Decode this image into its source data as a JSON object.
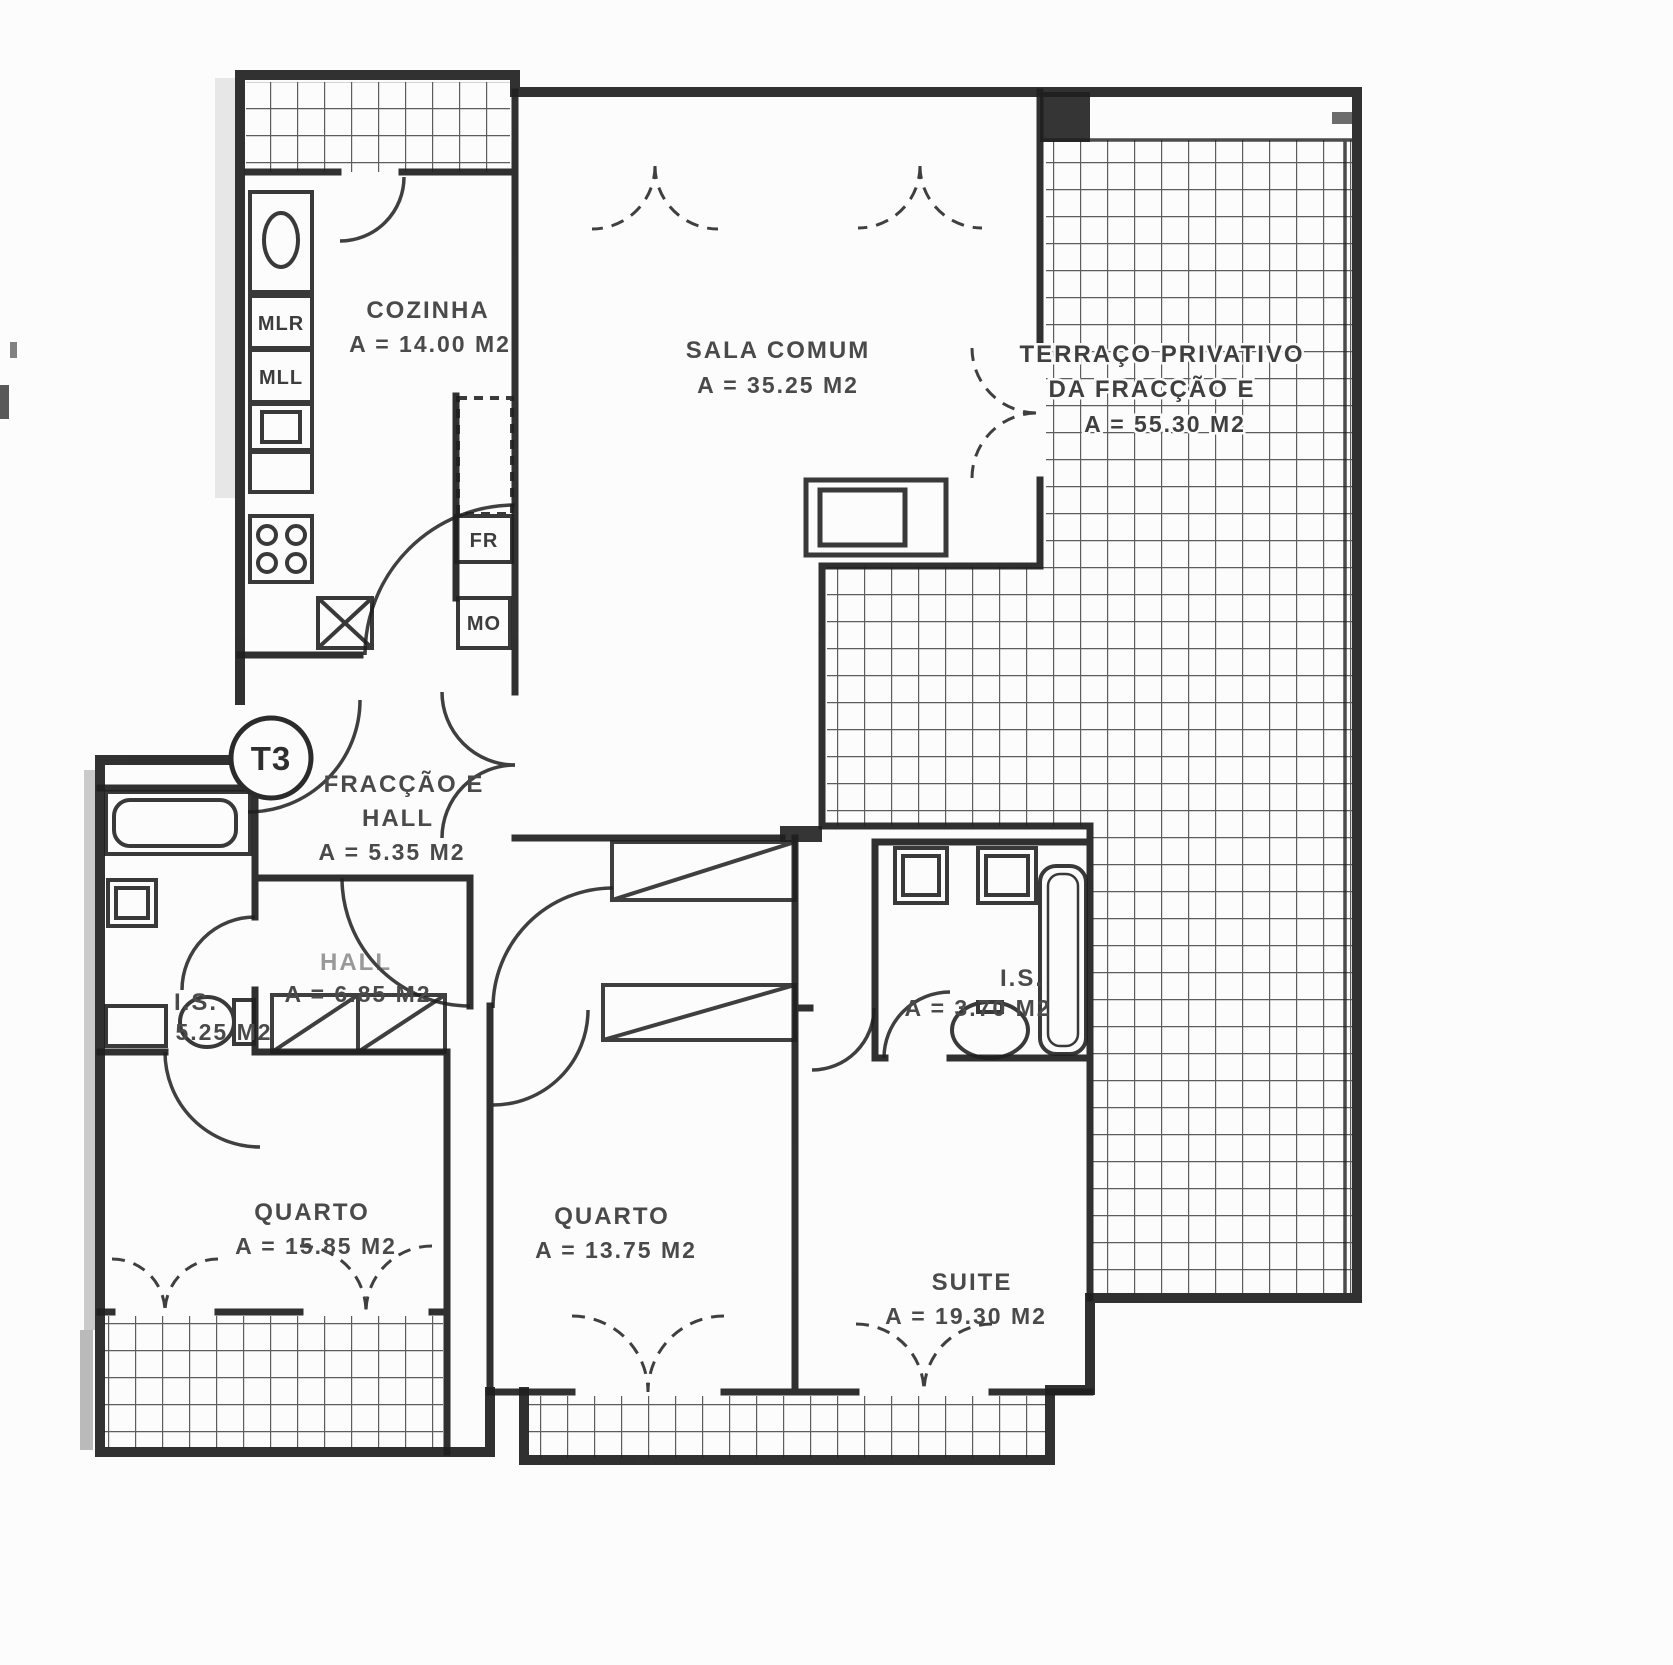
{
  "unit_badge": "T3",
  "rooms": {
    "cozinha": {
      "name": "COZINHA",
      "area": "A = 14.00 M2"
    },
    "sala": {
      "name": "SALA COMUM",
      "area": "A = 35.25 M2"
    },
    "terraco": {
      "line1": "TERRAÇO PRIVATIVO",
      "line2": "DA FRACÇÃO E",
      "area": "A = 55.30 M2"
    },
    "hall_entrada": {
      "line1": "FRACÇÃO E",
      "line2": "HALL",
      "area": "A = 5.35 M2"
    },
    "hall": {
      "name": "HALL",
      "area": "A = 6.85 M2"
    },
    "is_esquerda": {
      "name": "I.S.",
      "area": "5.25 M2"
    },
    "is_direita": {
      "name": "I.S.",
      "area": "A = 3.70 M2"
    },
    "quarto1": {
      "name": "QUARTO",
      "area": "A = 15.85 M2"
    },
    "quarto2": {
      "name": "QUARTO",
      "area": "A = 13.75 M2"
    },
    "suite": {
      "name": "SUITE",
      "area": "A = 19.30 M2"
    }
  },
  "appliances": {
    "mlr": "MLR",
    "mll": "MLL",
    "fr": "FR",
    "mo": "MO"
  },
  "colors": {
    "ink": "#1f1f1f",
    "tile_line": "#3a3a3a",
    "label_text": "#4a4a4a",
    "paper": "#fcfcfc"
  }
}
